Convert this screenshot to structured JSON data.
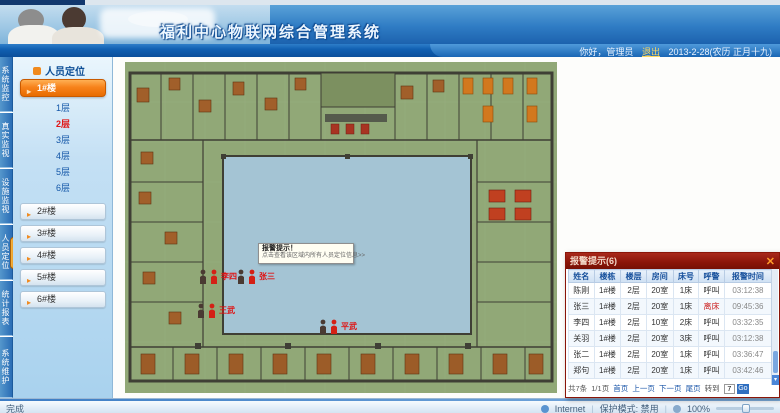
{
  "header": {
    "title": "福利中心物联网综合管理系统",
    "welcome": "你好，管理员",
    "logout": "退出",
    "date": "2013-2-28(农历 正月十九)"
  },
  "nav_tabs": [
    {
      "label": "系统监控"
    },
    {
      "label": "真实监视"
    },
    {
      "label": "设施监视"
    },
    {
      "label": "人员定位"
    },
    {
      "label": "统计报表"
    },
    {
      "label": "系统维护"
    }
  ],
  "sidebar": {
    "panel_title": "人员定位",
    "active_building": "1#楼",
    "floors": [
      {
        "label": "1层"
      },
      {
        "label": "2层"
      },
      {
        "label": "3层"
      },
      {
        "label": "4层"
      },
      {
        "label": "5层"
      },
      {
        "label": "6层"
      }
    ],
    "buildings": [
      {
        "label": "2#楼"
      },
      {
        "label": "3#楼"
      },
      {
        "label": "4#楼"
      },
      {
        "label": "5#楼"
      },
      {
        "label": "6#楼"
      }
    ]
  },
  "map": {
    "tooltip": {
      "line1": "报警提示！",
      "line2": "点击查看该区域内所有人员定位信息>>"
    },
    "markers": [
      {
        "name": "李四"
      },
      {
        "name": "张三"
      },
      {
        "name": "王武"
      },
      {
        "name": "平武"
      }
    ]
  },
  "alarm": {
    "title": "报警提示(6)",
    "columns": [
      "姓名",
      "楼栋",
      "楼层",
      "房间",
      "床号",
      "呼警",
      "报警时间"
    ],
    "rows": [
      [
        "陈刚",
        "1#楼",
        "2层",
        "20室",
        "1床",
        "呼叫",
        "03:12:38"
      ],
      [
        "张三",
        "1#楼",
        "2层",
        "20室",
        "1床",
        "离床",
        "09:45:36"
      ],
      [
        "李四",
        "1#楼",
        "2层",
        "10室",
        "2床",
        "呼叫",
        "03:32:35"
      ],
      [
        "关羽",
        "1#楼",
        "2层",
        "20室",
        "3床",
        "呼叫",
        "03:12:38"
      ],
      [
        "张二",
        "1#楼",
        "2层",
        "20室",
        "1床",
        "呼叫",
        "03:36:47"
      ],
      [
        "郑句",
        "1#楼",
        "2层",
        "20室",
        "1床",
        "呼叫",
        "03:42:46"
      ]
    ],
    "pager": {
      "total": "共7条",
      "page": "1/1页",
      "first": "首页",
      "prev": "上一页",
      "next": "下一页",
      "last": "尾页",
      "goto": "转到",
      "page_input": "7",
      "go": "Go"
    }
  },
  "statusbar": {
    "left": "完成",
    "zone": "Internet",
    "mode": "保护模式: 禁用",
    "zoom": "100%"
  },
  "colors": {
    "accent_orange": "#f7821b",
    "alarm_red": "#8a1508",
    "plan_green": "#91a877",
    "courtyard_blue": "#a4c4d4"
  }
}
